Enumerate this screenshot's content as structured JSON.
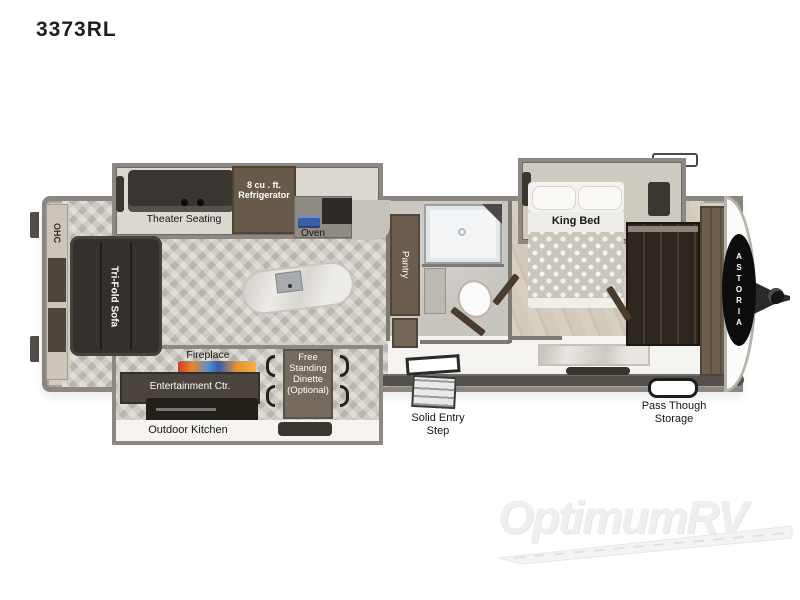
{
  "title": "3373RL",
  "plan": {
    "ohc": "OHC",
    "tri_fold_sofa": "Tri-Fold Sofa",
    "theater_seating": "Theater Seating",
    "refrigerator": "8 cu . ft.\nRefrigerator",
    "oven": "Oven",
    "pantry": "Pantry",
    "king_bed": "King Bed",
    "fireplace": "Fireplace",
    "entertainment_ctr": "Entertainment Ctr.",
    "outdoor_kitchen": "Outdoor Kitchen",
    "dinette": "Free\nStanding\nDinette\n(Optional)",
    "solid_entry_step": "Solid Entry\nStep",
    "pass_through_storage": "Pass Though\nStorage",
    "brand": "ASTORIA"
  },
  "watermark": "OptimumRV",
  "colors": {
    "wall_gray": "#8b8780",
    "furniture_dark": "#34312d",
    "cabinet_brown": "#675a4b",
    "cooktop_blue": "#3b5fa8",
    "flame_orange": "#e8862a",
    "flame_blue": "#2f5fae",
    "watermark_gray": "#efefef"
  }
}
